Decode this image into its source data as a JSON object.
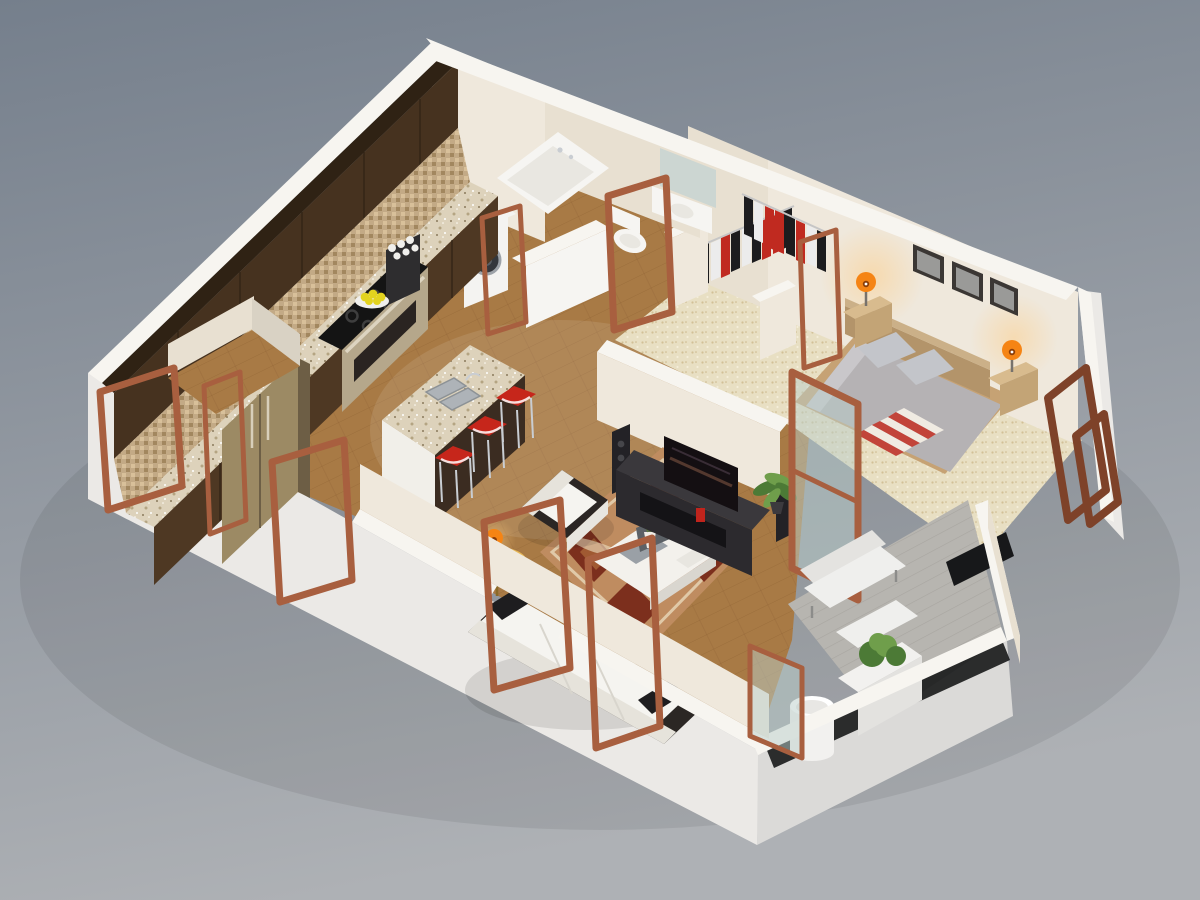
{
  "canvas": {
    "width": 1200,
    "height": 900
  },
  "colors": {
    "bgTop": "#757f8c",
    "bgBottom": "#aeb1b5",
    "wallTop": "#f7f5f0",
    "wallLit": "#efe8dc",
    "wallLit2": "#e8e0d1",
    "wallShade": "#d9d2c4",
    "wallOuter": "#ebe9e6",
    "foundationSide": "#dbdad8",
    "slabDark": "#17181a",
    "floorWood": "#a87a45",
    "plankLine": "#7d5027",
    "carpet": "#e8dfc3",
    "carpetDot": "#d2c096",
    "deck": "#b7b5b0",
    "deckLine": "#a19f9a",
    "granite": "#ddd2bb",
    "graniteDot": "#b4a482",
    "graniteDot2": "#8a7a5c",
    "backsplash": "#c3aa86",
    "backsplashDark": "#a2875f",
    "backsplashLight": "#d8c09a",
    "cabinetDark": "#46321f",
    "cabinetTop": "#2f2214",
    "cabinetFace": "#4e3823",
    "steel": "#b5a78b",
    "steelDark": "#6d5e45",
    "fridgeSteel": "#9c8a64",
    "cooktop": "#141414",
    "ovenWindow": "#2a2421",
    "washerWhite": "#f4f3f1",
    "washerDoor": "#34373c",
    "porcelain": "#f6f5f2",
    "tubInner": "#e9e7e1",
    "mirror": "#ccd6d2",
    "islandWhite": "#f1efe9",
    "islandDark": "#3b2c21",
    "stoolRed": "#c6261b",
    "chrome": "#c9cdd2",
    "railChrome": "#c6c6c6",
    "sofaWhite": "#f5f4f0",
    "sofaShadow": "#e6e3db",
    "cushionDark": "#1e1d1f",
    "sofaBase": "#2b2724",
    "rugBase": "#bf8c60",
    "rugDark": "#7c2f1d",
    "rugCream": "#e9d8ba",
    "rugMid": "#a05a32",
    "tableWood": "#d9a642",
    "lampOrange": "#f58414",
    "lampGlow": "#ffc97a",
    "coffeeWhite": "#f3f1ec",
    "laptopGray": "#9aa0a6",
    "laptopDark": "#5c6166",
    "consoleDark": "#2c2a2e",
    "consoleTop": "#3a383c",
    "shelfDark": "#141316",
    "tvScreen": "#140f12",
    "speakerDark": "#232226",
    "plantGreen": "#4c7a36",
    "plantGreen2": "#6f9e4b",
    "bedDuvet": "#b5b2b4",
    "bedDuvetLight": "#c9c7ca",
    "pillowGray": "#c3c5ca",
    "blanketRed": "#c2443a",
    "blanketCream": "#f0ebe2",
    "bedWood": "#c6a274",
    "headboard": "#b3946a",
    "nightstand": "#d8bb8e",
    "nightstandFace": "#c3a476",
    "pictureFrame": "#3b3734",
    "photoGray": "#9a9a98",
    "clothesBlack": "#1c1c1e",
    "clothesRed": "#c02a20",
    "clothesWhite": "#ececec",
    "doorWood": "#a85f3f",
    "doorWoodDark": "#7e4229",
    "glass": "#b9cdc9",
    "lemon": "#e3d31f",
    "plate": "#f0efec",
    "coffeeMachine": "#2e2d2f",
    "cupWhite": "#f0efec",
    "benchCushion": "#e4e3e0",
    "benchSeat": "#efefed",
    "cylinderWhite": "#f2f1ef"
  },
  "scene": {
    "type": "3d-isometric-floor-plan-render",
    "rooms": [
      {
        "name": "kitchen",
        "objects": [
          "upper-cabinets",
          "tile-backsplash",
          "granite-counter",
          "refrigerator",
          "cooktop",
          "oven",
          "coffee-machine",
          "lemon-bowl",
          "kitchen-island",
          "island-sink",
          "bar-stools"
        ]
      },
      {
        "name": "bathroom",
        "objects": [
          "bathtub",
          "toilet",
          "vanity-sink",
          "mirror",
          "washing-machine",
          "shower-wall"
        ]
      },
      {
        "name": "closet",
        "objects": [
          "hanging-clothes",
          "clothes-rails"
        ]
      },
      {
        "name": "bedroom",
        "objects": [
          "double-bed",
          "headboard",
          "pillows",
          "striped-blanket",
          "nightstands",
          "table-lamps",
          "wall-pictures",
          "window-frames"
        ]
      },
      {
        "name": "living-room",
        "objects": [
          "sofa",
          "armchair",
          "area-rug",
          "coffee-table",
          "laptop",
          "flower-vase",
          "side-table",
          "table-lamp",
          "tv-console",
          "television",
          "speakers",
          "potted-plant"
        ]
      },
      {
        "name": "balcony",
        "objects": [
          "lounge-bench",
          "ottoman",
          "planter-box",
          "shrub",
          "round-planter",
          "glass-partition"
        ]
      },
      {
        "name": "entry",
        "objects": [
          "open-door-frames"
        ]
      }
    ]
  }
}
